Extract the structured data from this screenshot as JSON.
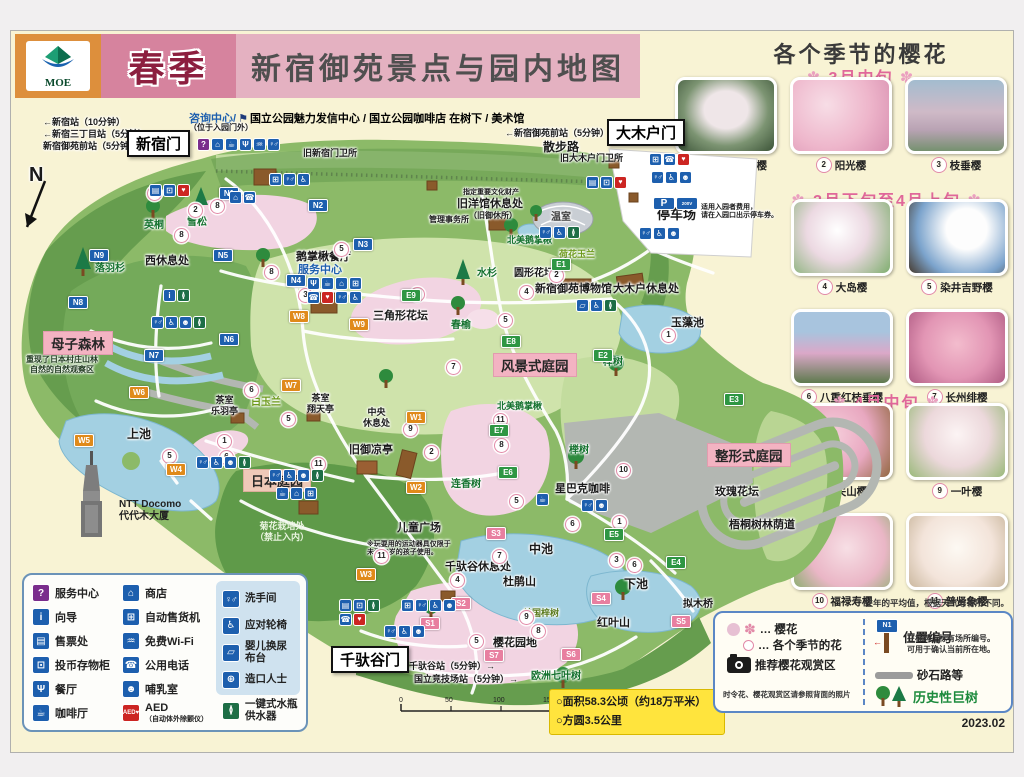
{
  "header": {
    "logo": "MOE",
    "season": "春季",
    "title": "新宿御苑景点与园内地图"
  },
  "sakura_panel": {
    "title": "各个季节的樱花",
    "sections": [
      {
        "heading": "3月中旬",
        "items": [
          {
            "num": "1",
            "name": "高远大叶早樱"
          },
          {
            "num": "2",
            "name": "阳光樱"
          },
          {
            "num": "3",
            "name": "枝垂樱"
          }
        ]
      },
      {
        "heading": "3月下旬至4月上旬",
        "items": [
          {
            "num": "4",
            "name": "大岛樱"
          },
          {
            "num": "5",
            "name": "染井吉野樱"
          },
          {
            "num": "6",
            "name": "八重红枝垂樱"
          },
          {
            "num": "7",
            "name": "长州绯樱"
          }
        ]
      },
      {
        "heading": "4月中旬",
        "items": [
          {
            "num": "8",
            "name": "关山樱"
          },
          {
            "num": "9",
            "name": "一叶樱"
          },
          {
            "num": "10",
            "name": "福禄寿樱"
          },
          {
            "num": "11",
            "name": "普贤象樱"
          }
        ]
      }
    ]
  },
  "icons": {
    "question": "?",
    "info": "i",
    "ticket": "▤",
    "locker": "⊡",
    "restaurant": "Ψ",
    "cafe": "☕",
    "shop": "⌂",
    "vending": "⊞",
    "wifi": "♒",
    "phone": "☎",
    "nursing": "☻",
    "aed": "♥",
    "wc": "♀♂",
    "wheelchair": "♿",
    "babychange": "▱",
    "ostomate": "⊕",
    "bottle": "≬",
    "parking": "P",
    "ev": "200V"
  },
  "facility_legend": {
    "col1": [
      {
        "icon": "service-center-icon",
        "glyph": "?",
        "label": "服务中心"
      },
      {
        "icon": "info-icon",
        "glyph": "i",
        "label": "向导"
      },
      {
        "icon": "ticket-icon",
        "glyph": "▤",
        "label": "售票处"
      },
      {
        "icon": "locker-icon",
        "glyph": "⊡",
        "label": "投币存物柜"
      },
      {
        "icon": "restaurant-icon",
        "glyph": "Ψ",
        "label": "餐厅"
      },
      {
        "icon": "cafe-icon",
        "glyph": "☕",
        "label": "咖啡厅"
      }
    ],
    "col2": [
      {
        "icon": "shop-icon",
        "glyph": "⌂",
        "label": "商店"
      },
      {
        "icon": "vending-icon",
        "glyph": "⊞",
        "label": "自动售货机"
      },
      {
        "icon": "wifi-icon",
        "glyph": "♒",
        "label": "免费Wi-Fi"
      },
      {
        "icon": "phone-icon",
        "glyph": "☎",
        "label": "公用电话"
      },
      {
        "icon": "nursing-icon",
        "glyph": "☻",
        "label": "哺乳室"
      },
      {
        "icon": "aed-icon",
        "glyph": "AED♥",
        "label": "AED",
        "sub": "（自动体外除颤仪）"
      }
    ],
    "col3": [
      {
        "icon": "toilet-icon",
        "glyph": "♀♂",
        "label": "洗手间"
      },
      {
        "icon": "wheelchair-icon",
        "glyph": "♿",
        "label": "应对轮椅"
      },
      {
        "icon": "baby-change-icon",
        "glyph": "▱",
        "label": "婴儿换尿布台"
      },
      {
        "icon": "ostomate-icon",
        "glyph": "⊕",
        "label": "造口人士"
      }
    ],
    "water": {
      "icon": "water-bottle-icon",
      "glyph": "≬",
      "label": "一键式水瓶供水器"
    }
  },
  "legend_right": {
    "note": "往年的平均值，根据天气等有所不同。",
    "flower_row1": "… 樱花",
    "flower_row2": "… 各个季节的花",
    "camera_label": "推荐樱花观赏区",
    "camera_note": "时令花、樱花观赏区请参照背面的照片",
    "sign_id": "N1",
    "pos_title": "位置编号",
    "pos_desc": "在标牌上标有场所编号。\n可用于确认当前所在地。",
    "gravel_label": "砂石路等",
    "giant_label": "历史性巨树",
    "version": "2023.02"
  },
  "info_box": {
    "line1": "○面积58.3公顷（约18万平米）",
    "line2": "○方圆3.5公里"
  },
  "scale": {
    "ticks": [
      "0",
      "50",
      "100",
      "150",
      "200m"
    ]
  },
  "map": {
    "compass": "N",
    "gates": {
      "shinjuku": "新宿门",
      "okido": "大木户门",
      "sendagaya": "千驮谷门"
    },
    "stations": {
      "s1": "←新宿站（10分钟）",
      "s2": "←新宿三丁目站（5分钟）",
      "s3": "新宿御苑前站（5分钟）→",
      "s4": "←新宿御苑前站（5分钟）",
      "s5": "千驮谷站（5分钟）→",
      "s6": "国立竞技场站（5分钟）→"
    },
    "top_info": {
      "a": "咨询中心/",
      "flag": "⚑",
      "b": "国立公园魅力发信中心 / 国立公园咖啡店 在树下 / 美术馆",
      "c": "（位于入园门外）"
    },
    "labels": {
      "sanpo": "散步路",
      "kyu_shinjuku": "旧新宿门卫所",
      "kyu_okido": "旧大木户门卫所",
      "yingtong1": "英桐",
      "xuesong": "雪松",
      "luoyushan": "落羽杉",
      "xi_rest": "西休息处",
      "ezhangqiu": "鹅掌楸餐厅",
      "fuwu": "服务中心",
      "zhiding": "指定重要文化财产",
      "jiuyangguan": "旧洋馆休息处",
      "jiuyuxiusuo": "（旧御休所）",
      "guanli": "管理事务所",
      "wenshi": "温室",
      "beimei1": "北美鹅掌楸",
      "hehua": "荷花玉兰",
      "shuishan": "水杉",
      "yuanxing": "圆形花坛",
      "bowuguan": "新宿御苑博物馆",
      "okido_rest": "大木户休息处",
      "yuzao": "玉藻池",
      "sanjiao": "三角形花坛",
      "chunyu": "春榆",
      "tingche": "停车场",
      "tingche_note": "适用入园者费用，\n请在入园口出示停车券。",
      "muzi": "母子森林",
      "muzi_note": "重现了日本村庄山林\n自然的自然观察区",
      "chashi1": "茶室\n乐羽亭",
      "baiyulan": "白玉兰",
      "chashi2": "茶室\n翔天亭",
      "zhongyang": "中央\n休息处",
      "shangchi": "上池",
      "jiuyuliang": "旧御凉亭",
      "riben": "日本庭园",
      "juhua": "菊花栽培处\n（禁止入内）",
      "ertong": "儿童广场",
      "ertong_note": "※玩耍用的运动器具仅限于\n未满13岁的孩子使用。",
      "qiantuo_rest": "千驮谷休息处",
      "zhongchi": "中池",
      "dujuan": "杜鹃山",
      "xiachi": "下池",
      "hongye": "红叶山",
      "meiguo": "美国梓树",
      "yinghua_yd": "樱花园地",
      "ouzhou": "欧洲七叶树",
      "nimuqiao": "拟木桥",
      "fengjing": "风景式庭园",
      "zhengxing": "整形式庭园",
      "meigui": "玫瑰花坛",
      "wutong": "梧桐树林荫道",
      "lianxiang": "连香树",
      "jushu1": "榉树",
      "jushu2": "榉树",
      "beimei2": "北美鹅掌楸",
      "xingbake": "星巴克咖啡",
      "ntt": "NTT Docomo\n代代木大厦"
    },
    "markers": {
      "N1": "N1",
      "N2": "N2",
      "N3": "N3",
      "N4": "N4",
      "N5": "N5",
      "N6": "N6",
      "N7": "N7",
      "N8": "N8",
      "N9": "N9",
      "W1": "W1",
      "W2": "W2",
      "W3": "W3",
      "W4": "W4",
      "W5": "W5",
      "W6": "W6",
      "W7": "W7",
      "W8": "W8",
      "W9": "W9",
      "E1": "E1",
      "E2": "E2",
      "E3": "E3",
      "E4": "E4",
      "E5": "E5",
      "E6": "E6",
      "E7": "E7",
      "E8": "E8",
      "E9": "E9",
      "S1": "S1",
      "S2": "S2",
      "S3": "S3",
      "S4": "S4",
      "S5": "S5",
      "S6": "S6",
      "S7": "S7"
    },
    "flowers": [
      "5",
      "2",
      "8",
      "8",
      "8",
      "5",
      "9",
      "5",
      "2",
      "4",
      "1",
      "7",
      "9",
      "2",
      "6",
      "5",
      "1",
      "6",
      "5",
      "11",
      "11",
      "7",
      "4",
      "9",
      "8",
      "5",
      "3",
      "6",
      "10",
      "11",
      "8",
      "5",
      "6",
      "1",
      "3"
    ]
  }
}
